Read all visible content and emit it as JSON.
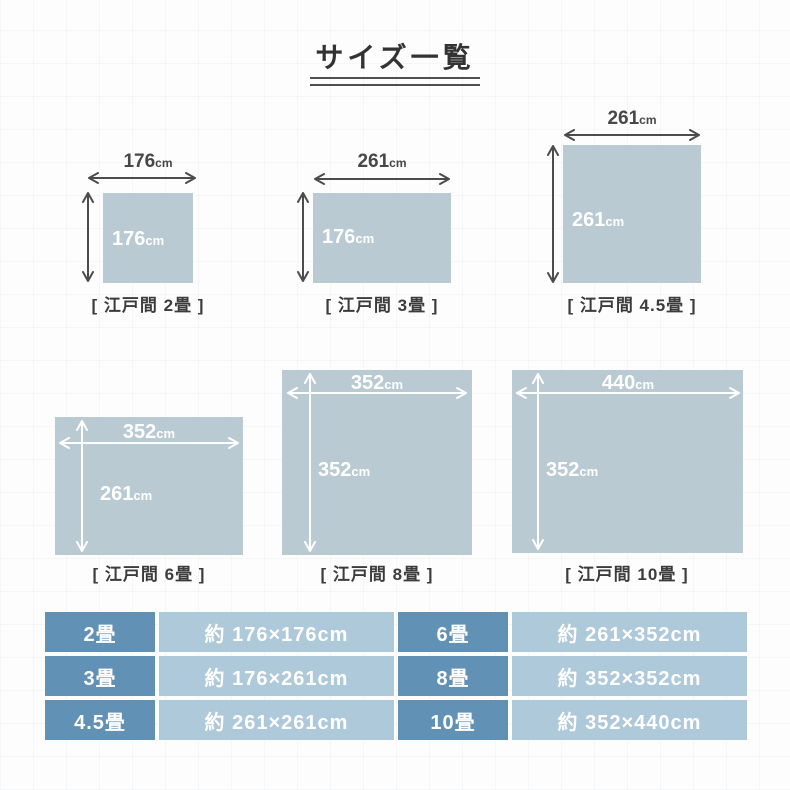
{
  "title": "サイズ一覧",
  "unit": "cm",
  "diagrams": [
    {
      "caption": "[ 江戸間 2畳 ]",
      "width_value": "176",
      "height_value": "176",
      "unit": "cm"
    },
    {
      "caption": "[ 江戸間 3畳 ]",
      "width_value": "261",
      "height_value": "176",
      "unit": "cm"
    },
    {
      "caption": "[ 江戸間 4.5畳 ]",
      "width_value": "261",
      "height_value": "261",
      "unit": "cm"
    },
    {
      "caption": "[ 江戸間 6畳 ]",
      "width_value": "352",
      "height_value": "261",
      "unit": "cm"
    },
    {
      "caption": "[ 江戸間 8畳 ]",
      "width_value": "352",
      "height_value": "352",
      "unit": "cm"
    },
    {
      "caption": "[ 江戸間 10畳 ]",
      "width_value": "440",
      "height_value": "352",
      "unit": "cm"
    }
  ],
  "table": {
    "rows": [
      {
        "left_size": "2畳",
        "left_dim": "約 176×176cm",
        "right_size": "6畳",
        "right_dim": "約 261×352cm"
      },
      {
        "left_size": "3畳",
        "left_dim": "約 176×261cm",
        "right_size": "8畳",
        "right_dim": "約 352×352cm"
      },
      {
        "left_size": "4.5畳",
        "left_dim": "約 261×261cm",
        "right_size": "10畳",
        "right_dim": "約 352×440cm"
      }
    ]
  },
  "colors": {
    "rug_fill": "#b9cad3",
    "arrow_dark": "#4c4c4c",
    "arrow_light": "#ffffff",
    "table_size_cell": "#6191b4",
    "table_dim_cell": "#aec9d9",
    "text_dark": "#3c3c3c"
  }
}
